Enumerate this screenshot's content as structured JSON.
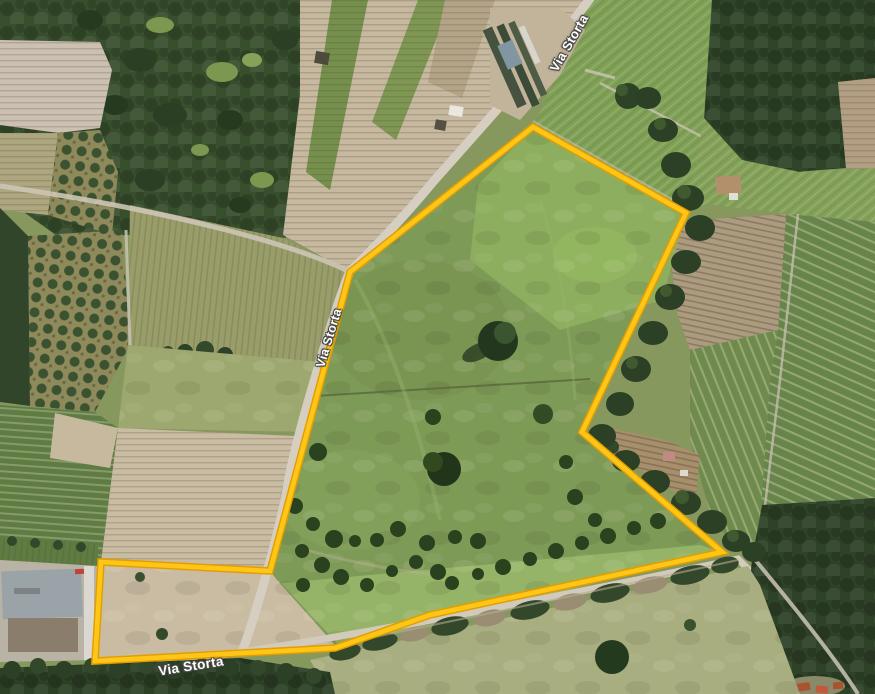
{
  "map": {
    "road_labels": [
      {
        "id": "top",
        "text": "Via Storta"
      },
      {
        "id": "middle",
        "text": "Via Storta"
      },
      {
        "id": "bottom",
        "text": "Via Storta"
      }
    ],
    "parcel_boundary": {
      "color": "#FFC517",
      "outline_color": "#E19E00",
      "points": "533,127 686,213 582,432 722,552 430,615 335,648 95,661 101,562 270,571 350,272"
    }
  }
}
